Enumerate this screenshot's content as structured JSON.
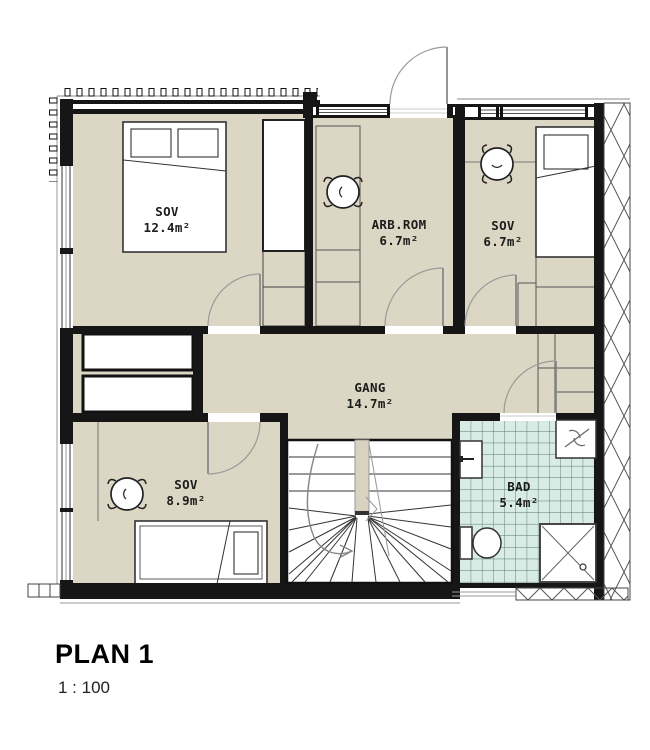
{
  "plan": {
    "title": "PLAN 1",
    "scale": "1 : 100",
    "rooms": [
      {
        "id": "sov-main",
        "name": "SOV",
        "area": "12.4m²"
      },
      {
        "id": "arb-rom",
        "name": "ARB.ROM",
        "area": "6.7m²"
      },
      {
        "id": "sov-small",
        "name": "SOV",
        "area": "6.7m²"
      },
      {
        "id": "gang",
        "name": "GANG",
        "area": "14.7m²"
      },
      {
        "id": "sov-mid",
        "name": "SOV",
        "area": "8.9m²"
      },
      {
        "id": "bad",
        "name": "BAD",
        "area": "5.4m²"
      }
    ],
    "colors": {
      "floor": "#dcd6c4",
      "bath_tile": "#d8ece5",
      "bath_tile_grid": "#54766e",
      "wall": "#161616",
      "door_arc": "#9a9a9a"
    }
  }
}
